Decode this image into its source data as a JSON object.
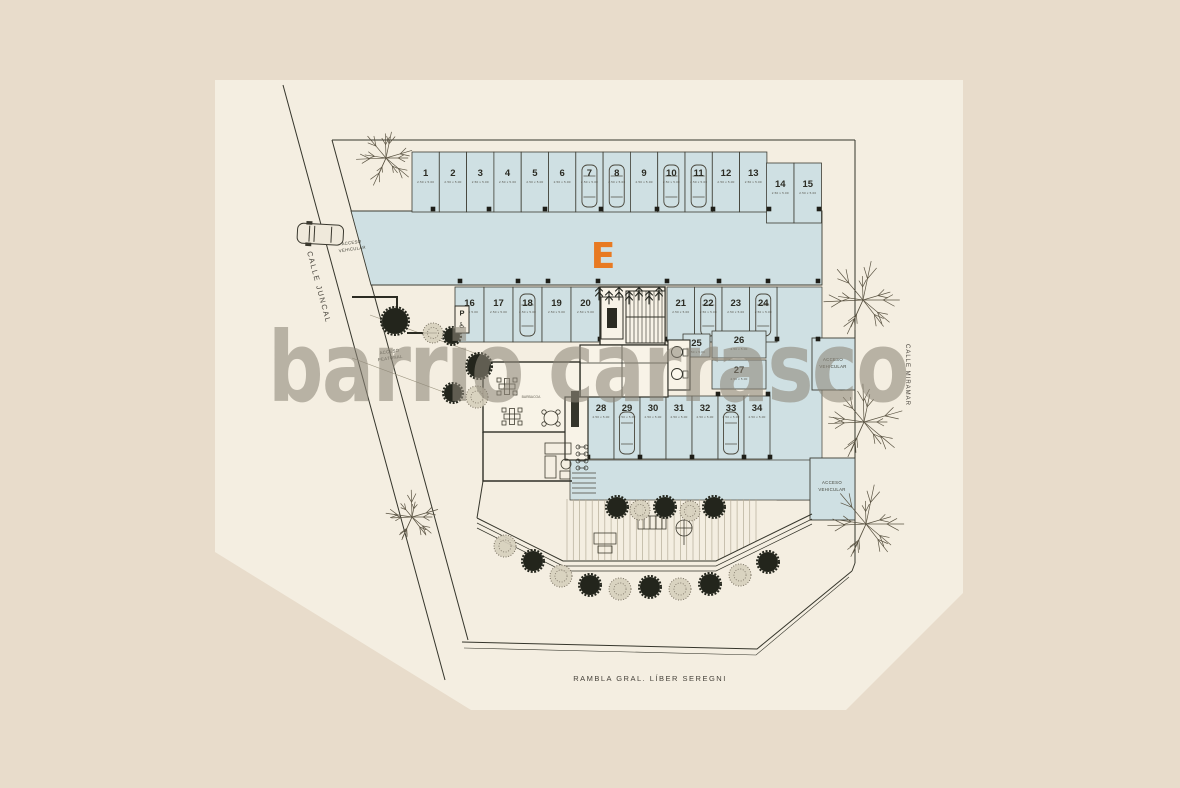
{
  "plan": {
    "building_label": "E",
    "watermark": "barrio carrasco",
    "streets": {
      "left": "CALLE JUNCAL",
      "right": "CALLE MIRAMAR",
      "bottom": "RAMBLA GRAL. LÍBER SEREGNI"
    },
    "labels": {
      "access_word": "ACCESO",
      "vehicular_word": "VEHICULAR",
      "pedestrian_word": "PEATONAL",
      "bbq_room": "BARBACOA",
      "accessible_sign_letter": "P",
      "accessible_sign_symbol": "♿"
    },
    "stall_dimension": "2.50 x 5.00",
    "stalls": {
      "row_top": [
        "1",
        "2",
        "3",
        "4",
        "5",
        "6",
        "7",
        "8",
        "9",
        "10",
        "11",
        "12",
        "13"
      ],
      "row_top_right": [
        "14",
        "15"
      ],
      "row_mid_left": [
        "16",
        "17",
        "18",
        "19",
        "20"
      ],
      "row_mid_right": [
        "21",
        "22",
        "23",
        "24"
      ],
      "stack_right": [
        "25",
        "26",
        "27"
      ],
      "row_bottom": [
        "28",
        "29",
        "30",
        "31",
        "32",
        "33",
        "34"
      ],
      "stalls_with_car": [
        "7",
        "8",
        "10",
        "11",
        "18",
        "22",
        "24",
        "29",
        "33"
      ],
      "accessible_stall": "16"
    },
    "colors": {
      "background": "#E8DCCB",
      "sheet": "#F4EEE1",
      "parking_blue": "#CFE0E3",
      "line_dark": "#35352B",
      "accent_orange": "#E87A22",
      "watermark_gray": "#8E8679"
    }
  }
}
